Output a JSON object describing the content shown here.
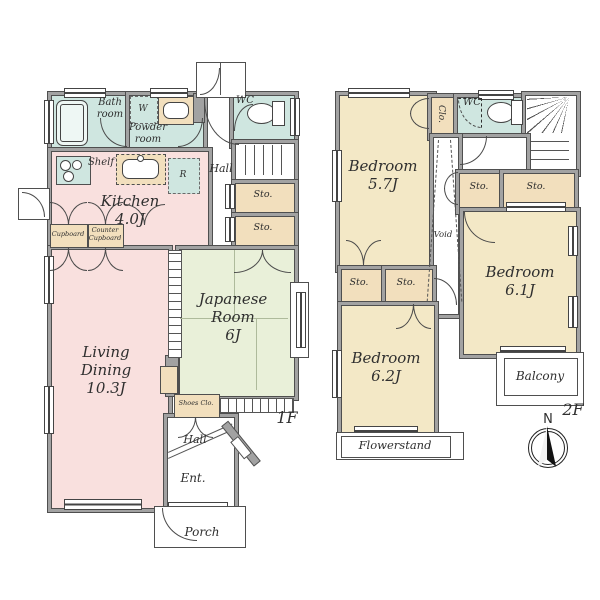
{
  "palette": {
    "wall": "#a2a2a2",
    "wallEdge": "#4f4f4f",
    "water": "#cfe6e0",
    "pink": "#f9e0de",
    "green": "#e9f0d9",
    "cream": "#f3e8c6",
    "tan": "#f2dfbd",
    "ink": "#2f2f2f"
  },
  "floor1": {
    "floor_label": "1F",
    "bath": "Bath\nroom",
    "washer": "W",
    "powder": "Powder\nroom",
    "wc": "WC",
    "shelf": "Shelf",
    "fridge": "R",
    "kitchen": "Kitchen\n4.0J",
    "hall_upper": "Hall",
    "sto_1": "Sto.",
    "sto_2": "Sto.",
    "cupboard": "Cupboard",
    "counter_cupboard": "Counter\nCupboard",
    "living_dining": "Living Dining\n10.3J",
    "japanese_room": "Japanese\nRoom\n6J",
    "shoes_closet": "Shoes Clo.",
    "hall_lower": "Hall",
    "entrance": "Ent.",
    "porch": "Porch"
  },
  "floor2": {
    "floor_label": "2F",
    "bedroom_a": "Bedroom\n5.7J",
    "closet": "Clo.",
    "wc": "WC",
    "void": "Void",
    "sto_1": "Sto.",
    "sto_2": "Sto.",
    "sto_3": "Sto.",
    "sto_4": "Sto.",
    "bedroom_b": "Bedroom\n6.2J",
    "bedroom_c": "Bedroom\n6.1J",
    "balcony": "Balcony",
    "flowerstand": "Flowerstand",
    "compass_north": "N"
  }
}
